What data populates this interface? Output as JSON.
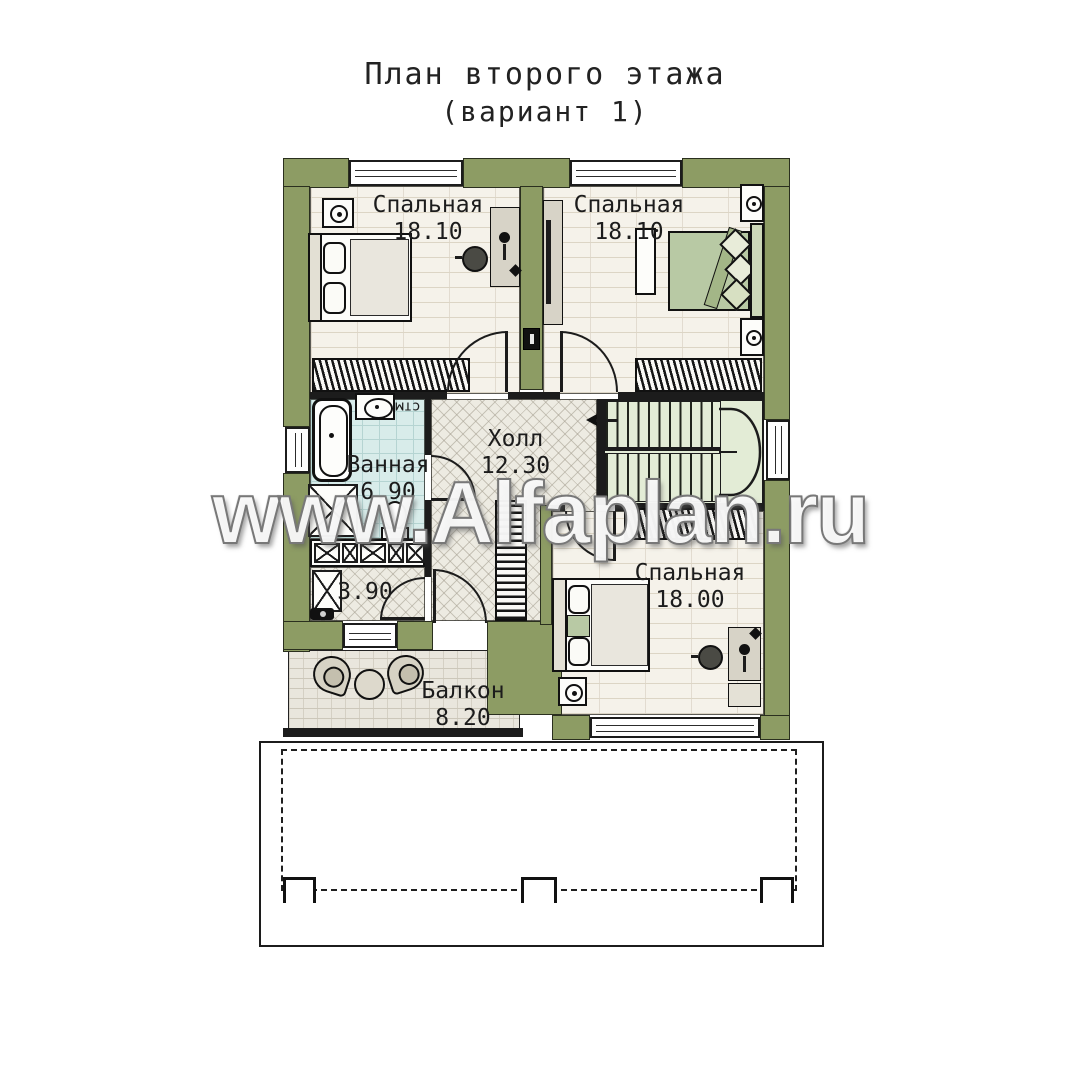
{
  "title": {
    "line1": "План второго этажа",
    "line2": "(вариант 1)"
  },
  "watermark": {
    "text": "www.Alfaplan.ru"
  },
  "rooms": {
    "bedroom_tl": {
      "name": "Спальная",
      "area": "18.10"
    },
    "bedroom_tr": {
      "name": "Спальная",
      "area": "18.10"
    },
    "bathroom": {
      "name": "Ванная",
      "area": "6.90"
    },
    "hall": {
      "name": "Холл",
      "area": "12.30"
    },
    "closet": {
      "area": "3.90"
    },
    "bedroom_br": {
      "name": "Спальная",
      "area": "18.00"
    },
    "balcony": {
      "name": "Балкон",
      "area": "8.20"
    }
  },
  "annotations": {
    "washing_machine": "стм"
  },
  "colors": {
    "wall": "#8d9c64",
    "floor_light": "#f5f2ea",
    "bath_tile": "#d8ecea",
    "stairs_floor": "#e3ecd6",
    "bed_green": "#b8c9a4",
    "outline": "#1c1c1c"
  }
}
